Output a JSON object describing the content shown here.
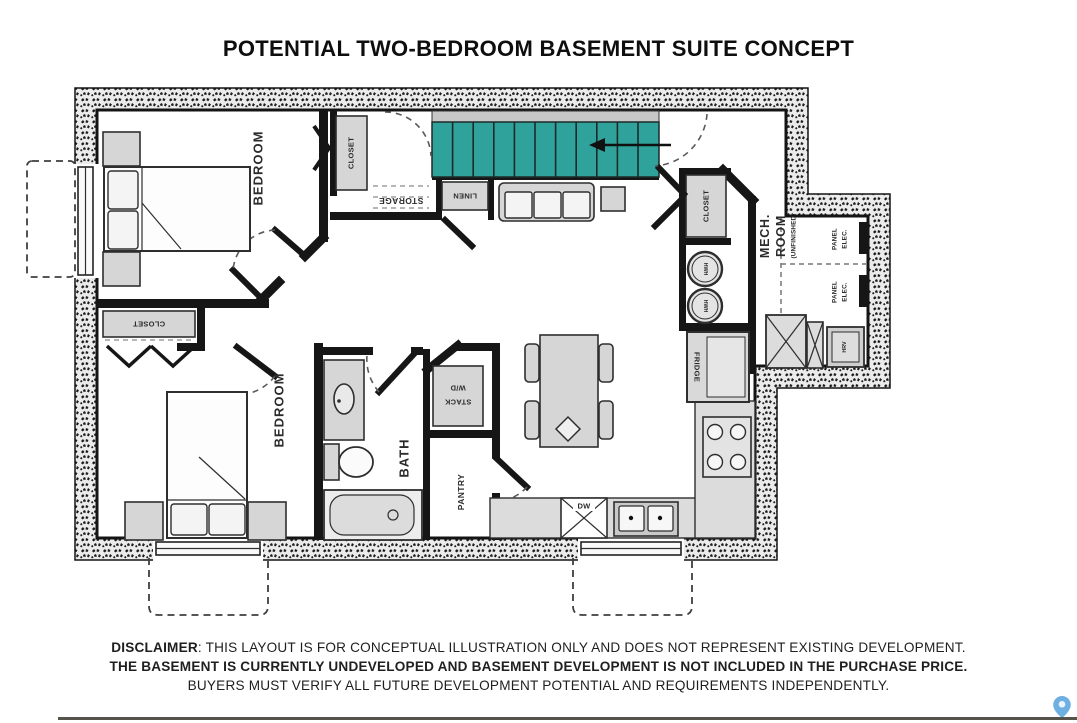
{
  "title": "POTENTIAL TWO-BEDROOM BASEMENT SUITE CONCEPT",
  "labels": {
    "bedroom1": "BEDROOM",
    "bedroom2": "BEDROOM",
    "bath": "BATH",
    "pantry": "PANTRY",
    "storage": "STORAGE",
    "linen": "LINEN",
    "closet": "CLOSET",
    "mech_line1": "MECH.",
    "mech_line2": "ROOM",
    "mech_note": "(UNFINISHED)",
    "stack_line1": "STACK",
    "stack_line2": "W/D",
    "dw": "DW",
    "fridge": "FRIDGE",
    "hwh": "HWH",
    "hrv": "HRV",
    "panel_line1": "PANEL",
    "panel_line2": "ELEC."
  },
  "colors": {
    "stairs_accent": "#2fa39b",
    "pin": "#6fb0e2",
    "wall": "#161616"
  },
  "disclaimer": {
    "line1_label": "DISCLAIMER",
    "line1_rest": ": THIS LAYOUT IS FOR CONCEPTUAL ILLUSTRATION ONLY AND DOES NOT REPRESENT EXISTING DEVELOPMENT.",
    "line2": "THE BASEMENT IS CURRENTLY UNDEVELOPED AND BASEMENT DEVELOPMENT IS NOT INCLUDED IN THE PURCHASE PRICE.",
    "line3": "BUYERS MUST VERIFY ALL FUTURE DEVELOPMENT POTENTIAL AND REQUIREMENTS INDEPENDENTLY."
  }
}
